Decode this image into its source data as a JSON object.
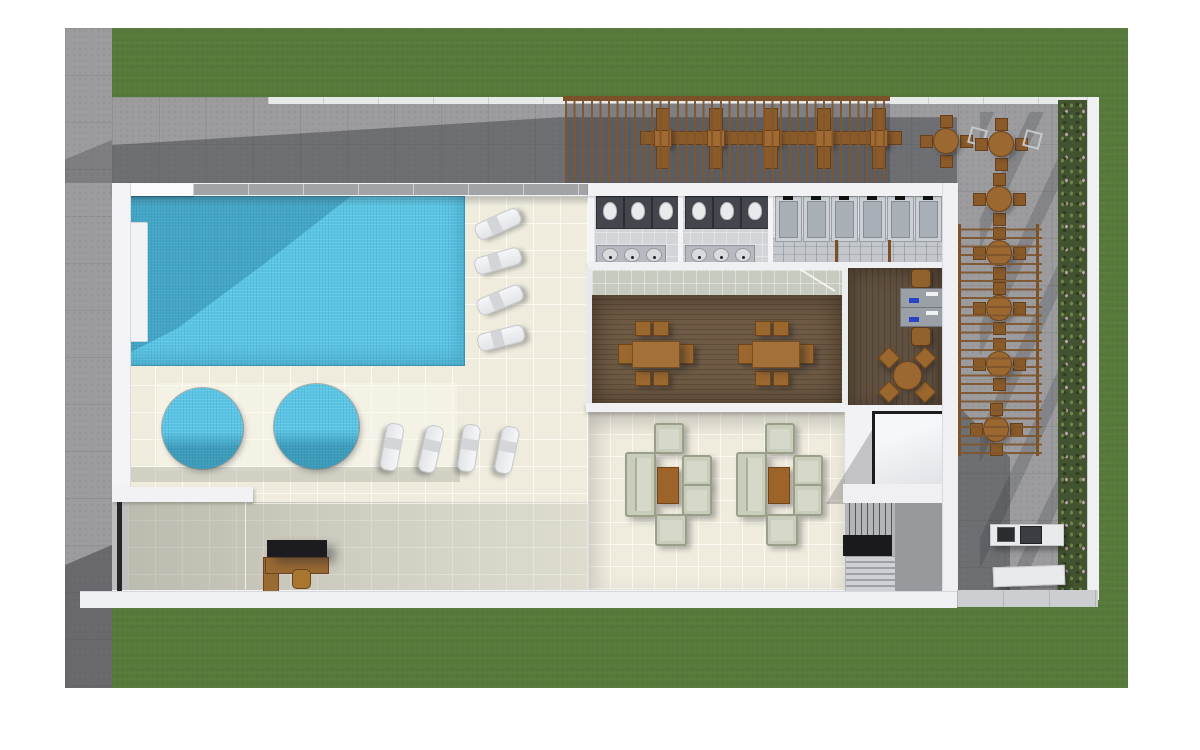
{
  "scene": {
    "type": "architectural-floor-plan-render",
    "description": "Top-down 3D rendered amenity deck floor plan: swimming pool with two round spas, sun loungers, restrooms and showers, indoor restaurant, lounge seating, elevator and stairs, pergola dining terraces, hedge and lawn border",
    "colors": {
      "grass": "#567a3a",
      "concrete": "#9c9c9f",
      "concrete_shadow": "#54565c",
      "wall_white": "#f4f4f6",
      "deck_tile": "#efecdd",
      "pool_water": "#5ac5e5",
      "wood_floor": "#6f5b45",
      "furniture_wood": "#9a6830",
      "sofa_fabric": "#c9cdbb",
      "pergola_wood": "#7b5129",
      "hedge_green": "#42542f",
      "hedge_flower": "#d5a8c7",
      "stall_dark": "#43464c",
      "elevator_frame": "#1b1c1e"
    },
    "areas": [
      {
        "name": "lawn-border"
      },
      {
        "name": "sidewalk"
      },
      {
        "name": "upper-pergola-terrace"
      },
      {
        "name": "right-pergola-terrace"
      },
      {
        "name": "pool"
      },
      {
        "name": "spa-pair"
      },
      {
        "name": "pool-deck"
      },
      {
        "name": "restrooms-and-showers"
      },
      {
        "name": "restaurant"
      },
      {
        "name": "game-room"
      },
      {
        "name": "lounge-terrace"
      },
      {
        "name": "elevator"
      },
      {
        "name": "stairs"
      },
      {
        "name": "reception-desk"
      },
      {
        "name": "bbq-corner"
      },
      {
        "name": "hedge-planter"
      }
    ],
    "counts": {
      "loungers": 8,
      "spas": 2,
      "banquet_tables": 5,
      "round_terrace_tables": 7,
      "dining_tables": 2,
      "sofa_groups": 2,
      "toilet_stalls": 6,
      "sinks": 6,
      "showers": 6,
      "game_desks": 2
    }
  },
  "furniture": {
    "loungers": [
      {
        "x": 497,
        "y": 223,
        "r": -24
      },
      {
        "x": 497,
        "y": 260,
        "r": -16
      },
      {
        "x": 499,
        "y": 299,
        "r": -22
      },
      {
        "x": 500,
        "y": 337,
        "r": -14
      },
      {
        "x": 391,
        "y": 446,
        "r": 100
      },
      {
        "x": 430,
        "y": 448,
        "r": 103
      },
      {
        "x": 468,
        "y": 447,
        "r": 99
      },
      {
        "x": 506,
        "y": 449,
        "r": 102
      }
    ],
    "banquet": {
      "bar": {
        "x": 640,
        "y": 131,
        "w": 260,
        "h": 12
      },
      "tables_cx": [
        662,
        715,
        770,
        823,
        878
      ],
      "table_y": 129,
      "table_size": 16,
      "bench_w": 12,
      "bench_h": 21,
      "bench_top_y": 108,
      "bench_bot_y": 146
    },
    "round_tables": [
      {
        "cx": 945,
        "cy": 140,
        "ghost": true
      },
      {
        "cx": 1000,
        "cy": 143,
        "ghost": true
      },
      {
        "cx": 998,
        "cy": 198,
        "ghost": false
      },
      {
        "cx": 998,
        "cy": 252,
        "ghost": false
      },
      {
        "cx": 998,
        "cy": 307,
        "ghost": false
      },
      {
        "cx": 998,
        "cy": 363,
        "ghost": false
      },
      {
        "cx": 995,
        "cy": 428,
        "ghost": false
      }
    ],
    "dining_tables": [
      {
        "cx": 655,
        "cy": 353
      },
      {
        "cx": 775,
        "cy": 353
      }
    ],
    "sofa_groups": [
      {
        "cx": 666
      },
      {
        "cx": 777
      }
    ],
    "spas": [
      {
        "cx": 202,
        "cy": 428,
        "d": 81
      },
      {
        "cx": 316,
        "cy": 426,
        "d": 85
      }
    ],
    "restrooms": {
      "rooms_x0": [
        596,
        685
      ],
      "stalls_per_room": 3,
      "stall_w": 26,
      "stall_h": 31,
      "stall_gap": 28,
      "stall_y": 196,
      "sink_counter_y": 245,
      "sink_counter_w": 68,
      "sink_counter_h": 17,
      "showers_x0": 775,
      "shower_n": 6,
      "shower_w": 25,
      "shower_h": 44,
      "shower_gap": 28,
      "shower_y": 196,
      "bench_posts": [
        {
          "x": 835
        },
        {
          "x": 888
        }
      ]
    },
    "game_room": {
      "desks": [
        {
          "x": 900,
          "y": 288
        },
        {
          "x": 900,
          "y": 307
        }
      ],
      "chairs": [
        {
          "x": 911,
          "y": 269
        },
        {
          "x": 911,
          "y": 327
        }
      ],
      "round_table": {
        "cx": 906,
        "cy": 374
      },
      "diag_chairs": [
        {
          "cx": 924,
          "cy": 357
        },
        {
          "cx": 924,
          "cy": 391
        },
        {
          "cx": 888,
          "cy": 391
        },
        {
          "cx": 888,
          "cy": 357
        }
      ]
    }
  }
}
